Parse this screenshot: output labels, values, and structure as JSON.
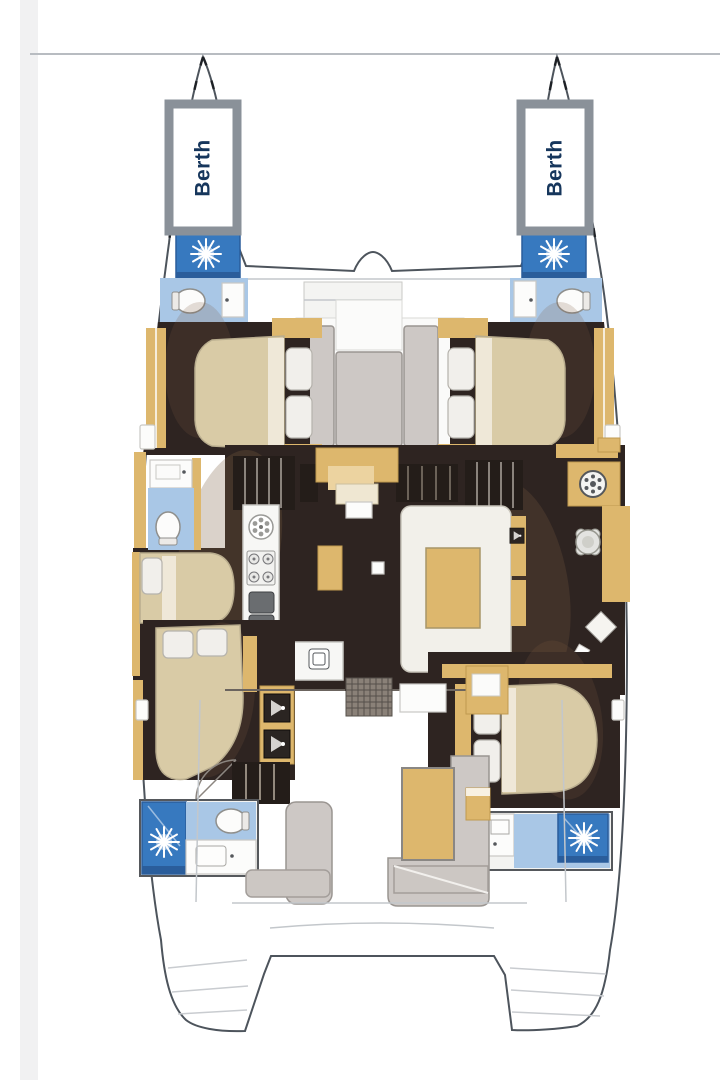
{
  "labels": {
    "port_berth": "Berth",
    "starboard_berth": "Berth"
  },
  "colors": {
    "page_bg": "#ffffff",
    "left_strip": "#f1f1f2",
    "hull_stroke": "#4d545c",
    "faint_line": "#c3c7cb",
    "berth_frame": "#8a9199",
    "berth_text": "#16365c",
    "shower_blue": "#3779bf",
    "shower_blue_dark": "#2a5d9b",
    "bath_blue": "#a9c7e6",
    "tan": "#ddb76d",
    "tan_dark": "#c09a50",
    "dark_floor": "#2e2421",
    "bed": "#d9cba6",
    "bed_light": "#efe8d8",
    "pillow": "#f1efeb",
    "cushion": "#cdc8c5",
    "cushion_edge": "#9a9591",
    "sofa": "#f2f0ea",
    "counter": "#f7f7f5",
    "platform": "#ccc7c3",
    "appliance": "#55585c",
    "shadow_brown": "#7b5c42"
  }
}
